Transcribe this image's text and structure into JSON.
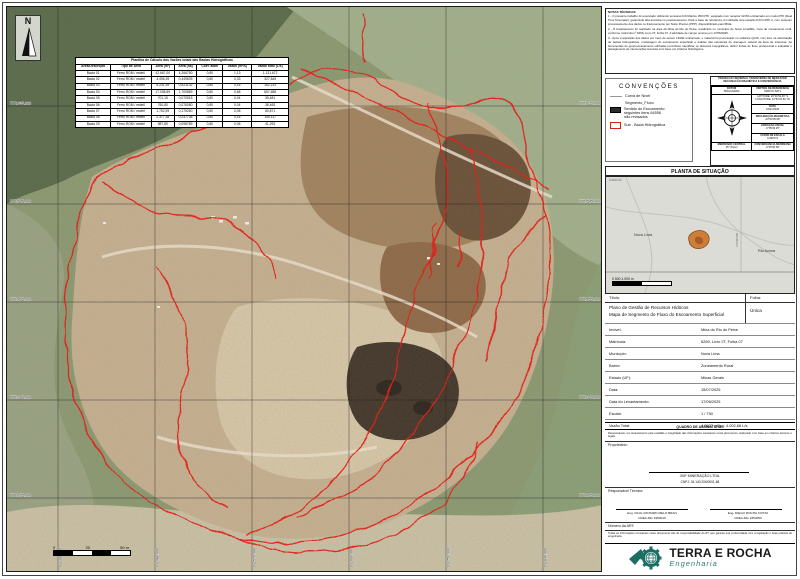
{
  "colors": {
    "flow_red": "#e2231a",
    "logo_teal": "#1b6e64",
    "site_orange": "#cd7f3a"
  },
  "map": {
    "north_label": "N",
    "grid": {
      "northings": [
        "7771635.000",
        "7771545.000",
        "7771455.000",
        "7771365.000",
        "7771275.000"
      ],
      "eastings": [
        "612390.000",
        "612480.000",
        "612570.000",
        "612660.000",
        "612750.000",
        "612840.000"
      ]
    },
    "scale_bar": {
      "labels": [
        "0",
        "25",
        "50 m"
      ]
    },
    "flow_table": {
      "title": "Planilha de Cálculo das Vazões totais das Bacias Hidrográficas",
      "columns": [
        "Área/Descrição",
        "Tipo de Área",
        "Área (m²)",
        "Área (ha)",
        "Coef. adim",
        "Vazão (m³/s)",
        "Vazão total (L/s)"
      ],
      "rows": [
        [
          "Bacia 01",
          "Ferro ROM / estéril",
          "42.667,00",
          "4,266750",
          "0,80",
          "1,13",
          "1.131,672"
        ],
        [
          "Bacia 02",
          "Ferro ROM / estéril",
          "4.496,39",
          "0,449639",
          "0,80",
          "0,33",
          "327,845"
        ],
        [
          "Bacia 03",
          "Ferro ROM / estéril",
          "5.231,39",
          "0,523132",
          "0,80",
          "0,16",
          "162,213"
        ],
        [
          "Bacia 04",
          "Ferro ROM / estéril",
          "17.008,69",
          "1,700869",
          "0,80",
          "0,68",
          "657,488"
        ],
        [
          "Bacia 05",
          "Ferro ROM / estéril",
          "701,15",
          "0,070515",
          "0,80",
          "0,04",
          "35,481"
        ],
        [
          "Bacia 06",
          "Ferro ROM / estéril",
          "760,80",
          "0,076080",
          "0,80",
          "0,04",
          "38,465"
        ],
        [
          "Bacia 07",
          "Ferro ROM / estéril",
          "1.752,59",
          "0,175260",
          "0,80",
          "0,08",
          "80,871"
        ],
        [
          "Bacia 08",
          "Ferro ROM / estéril",
          "2.377,38",
          "0,237738",
          "0,80",
          "0,16",
          "190,117"
        ],
        [
          "Bacia 09",
          "Ferro ROM / estéril",
          "987,89",
          "0,098789",
          "0,80",
          "0,06",
          "41,293"
        ]
      ]
    }
  },
  "panel": {
    "notes": {
      "title": "NOTAS TÉCNICAS:",
      "items": [
        "1 - O presente trabalho foi executado utilizando sensores DJI Matrice 350 RTK, equipado com receptor GNSS embarcado em modo RTK (Real Time Kinematic), garantindo alta acurácia no posicionamento. Para a base de referência, foi utilizada uma estação DJI D-RTK 2, com posterior processamento dos dados no fracionamento por Norte Preciso (PPP), disponibilizado pelo IBGE.",
        "2 - O levantamento foi realizado na área da Mina do Rio do Peixe, localizado no município de Nova Lima/MG, zona de zoneamento rural, conforme matrícula nº 6269, Livro 2T, Folha 07. A atividade de campo ocorreu em 17/06/2025.",
        "3 - Após a aquisição dos dados por meio de sensor LiDAR embarcado, o material foi processado no software QGIS, com foco na delimitação de bacias hidrográficas, modelagem do escoamento superficial e análise das estruturas de drenagem natural da área de interesse. As ferramentas de geoprocessamento utilizadas permitiram identificar os divisores topográficos, definir linhas de fluxo preferencial e subsidiar o planejamento de intervenções técnicas com base em critérios hidrológicos."
      ]
    },
    "legend": {
      "title": "CONVENÇÕES",
      "contour": "Curva de Nível",
      "group": "Segmento_Fluxo",
      "flow1": "Sentido do Escoamento:",
      "flow2": "seguintes itens 84556",
      "flow3": "não revisados",
      "basin": "Sub - Bacia Hidrográfica"
    },
    "projection": {
      "header1": "PROJEÇÃO UNIVERSAL TRANSVERSA DE MERCATOR",
      "header2": "DECLINAÇÃO MAGNÉTICA E CONVERGÊNCIA",
      "datum_label": "DATUM",
      "datum": "SIRGAS2000",
      "vertex_label": "VÉRTICE DE REFERÊNCIA",
      "vertex": "MARCO-SAT1",
      "latitude": "LATITUDE: 20°01'52,46\" S",
      "longitude": "LONGITUDE: 43°51'10,81\" W",
      "date_label": "DATA",
      "date": "15/07/2025",
      "decl_label": "DECLINAÇÃO MAGNÉTICA",
      "decl": "-23°03'35,08\"",
      "var_label": "VARIAÇÃO ANUAL",
      "var": "-0°05'29,25\"",
      "scale_label": "FATOR DE ESCALA",
      "scale": "0,999774",
      "conv_label": "CONVERGÊNCIA MERIDIANA",
      "conv": "-0°03'30,68\"",
      "meridian_label": "MERIDIANO CENTRAL",
      "meridian": "45° W(Gr)"
    },
    "situation": {
      "title": "PLANTA DE SITUAÇÃO",
      "city": "Nova Lima",
      "city2": "Rio Acima",
      "coord_top": "612500.000",
      "coord_line": "7771500.000",
      "scale_labels": "0        500        1.000 m"
    },
    "title_block": {
      "title_label": "Título:",
      "sheet_label": "Folha:",
      "title_line1": "Plano de Gestão de Recursos Hídricos",
      "title_line2": "Mapa de Segmento do Fluxo do Escoamento Superficial",
      "sheet_value": "Única",
      "rows": [
        {
          "label": "Imóvel:",
          "value": "Mina do Rio do Peixe"
        },
        {
          "label": "Matrícula:",
          "value": "6269, Livro 2T, Folha 07"
        },
        {
          "label": "Município:",
          "value": "Nova Lima"
        },
        {
          "label": "Bairro:",
          "value": "Zoneamento Rural"
        },
        {
          "label": "Estado (UF):",
          "value": "Minas Gerais"
        },
        {
          "label": "Data:",
          "value": "15/07/2025"
        },
        {
          "label": "Data do Levantamento:",
          "value": "17/06/2025"
        },
        {
          "label": "Escala:",
          "value": "1 / 750"
        },
        {
          "label": "Vazão Total:",
          "value": "4,0027 m³/s   =   4.002,66 L/s"
        }
      ],
      "signatures_header": "QUADRO DE ASSINATURAS",
      "resp_note": "Responsáveis: em levantamento pela exatidão e integridade das informações constantes neste documento, elaborado com base em critérios técnicos e legais.",
      "owner_label": "Proprietário:",
      "owner_name": "JMF MINERAÇÃO LTDA.",
      "owner_cnpj": "CNPJ: 34.140.206/0001-68",
      "tech_label": "Responsável Técnico:",
      "eng1_name": "Eng. RAUL RICHARD MELO BRAN",
      "eng1_crea": "CREA-MG 1950010",
      "eng2_name": "Eng. DIEGO ROCHA COSTA",
      "eng2_crea": "CREA-MG 2354050",
      "art_label": "Número da ART:",
      "disclaimer": "Todas as informações constantes neste documento são de responsabilidade do RT, que garante sua conformidade com a legislação e boas práticas de engenharia.",
      "logo_name": "TERRA E ROCHA",
      "logo_sub": "Engenharia"
    }
  }
}
